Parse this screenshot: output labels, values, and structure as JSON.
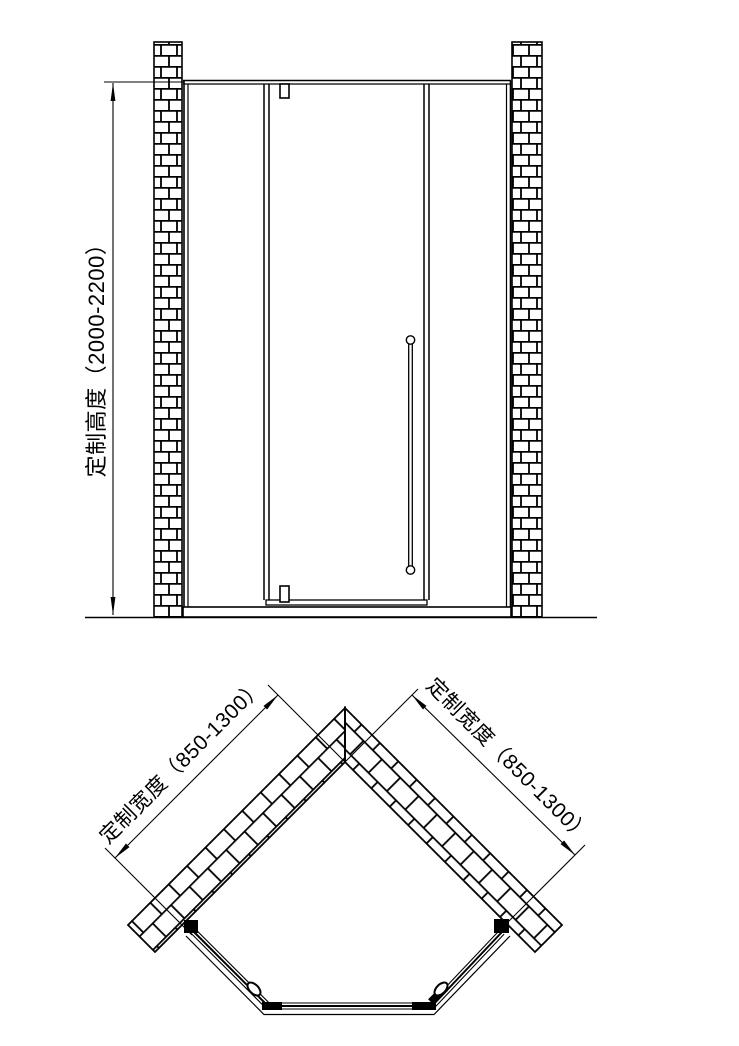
{
  "page": {
    "background_color": "#ffffff",
    "line_color": "#000000",
    "description": "Technical drawing of corner shower enclosure: front elevation and plan view"
  },
  "elevation": {
    "height_dimension": {
      "label": "定制高度（2000-2200）",
      "min": 2000,
      "max": 2200
    }
  },
  "plan": {
    "left_width_dimension": {
      "label": "定制宽度（850-1300）",
      "min": 850,
      "max": 1300
    },
    "right_width_dimension": {
      "label": "定制宽度（850-1300）",
      "min": 850,
      "max": 1300
    }
  }
}
